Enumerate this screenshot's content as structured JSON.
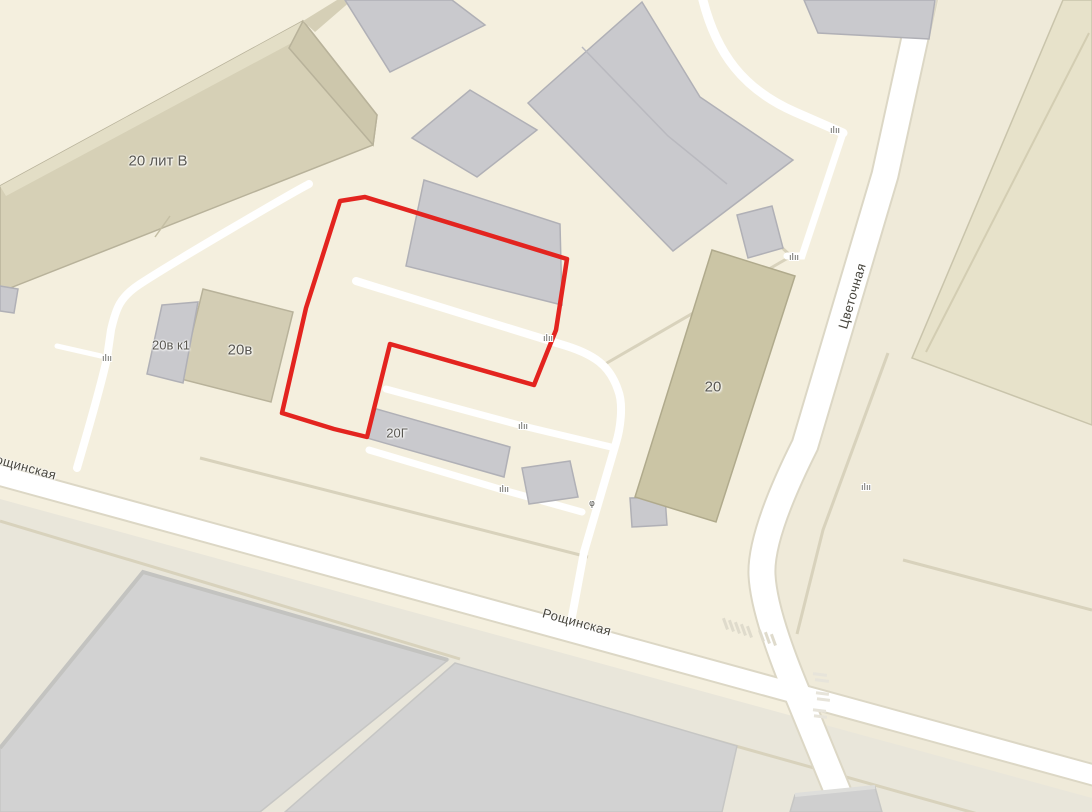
{
  "map": {
    "description": "city map fragment with red selected parcel outline",
    "background_color": "#f4efde",
    "selection": {
      "name": "selected-parcel-outline",
      "color": "#e3241f"
    },
    "building_labels": [
      {
        "id": "b20litv",
        "text": "20 лит В"
      },
      {
        "id": "b20vk1",
        "text": "20в к1"
      },
      {
        "id": "b20v",
        "text": "20в"
      },
      {
        "id": "b20g",
        "text": "20Г"
      },
      {
        "id": "b20",
        "text": "20"
      }
    ],
    "street_labels": [
      {
        "id": "roshchinskaya-left",
        "text": "Рощинская"
      },
      {
        "id": "roshchinskaya-center",
        "text": "Рощинская"
      },
      {
        "id": "tsvetochnaya",
        "text": "Цветочная"
      }
    ],
    "icons": {
      "gate": {
        "glyph": "ılıı"
      },
      "barrier": {
        "glyph": "φ"
      }
    },
    "palette": {
      "building_gray": "#c9c9cd",
      "building_khaki": "#d6d0b6",
      "building_olive": "#cbc5a5",
      "building_bottom_gray": "#d2d2d2",
      "road_white": "#ffffff",
      "parcel_south": "#e9e6da",
      "parcel_east": "#efead9",
      "fence_line": "#d8d2bc",
      "label_color": "#585650"
    }
  }
}
